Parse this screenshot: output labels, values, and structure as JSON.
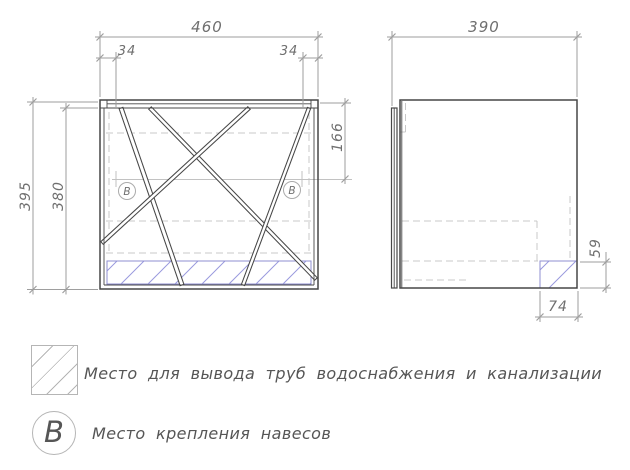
{
  "drawing": {
    "front_view": {
      "dim_width": "460",
      "dim_offset_left": "34",
      "dim_offset_right": "34",
      "dim_height_outer": "395",
      "dim_height_inner": "380",
      "dim_hanger_drop": "166",
      "hanger_marker": "B"
    },
    "side_view": {
      "dim_depth": "390",
      "dim_pipe_zone_height": "59",
      "dim_pipe_zone_width": "74"
    }
  },
  "legend": {
    "pipe_zone_label": "Место для вывода труб водоснабжения и канализации",
    "hanger_symbol": "B",
    "hanger_label": "Место крепления навесов"
  },
  "colors": {
    "line": "#474747",
    "dim": "#9e9e9e",
    "dim_text": "#6f6f6f",
    "dash": "#c8c8c8",
    "light": "#c2c2c2",
    "hatch": "#9a9ade",
    "hatch_border": "#8f8fd2",
    "legend_line": "#b5b5b5",
    "legend_text": "#565656"
  }
}
